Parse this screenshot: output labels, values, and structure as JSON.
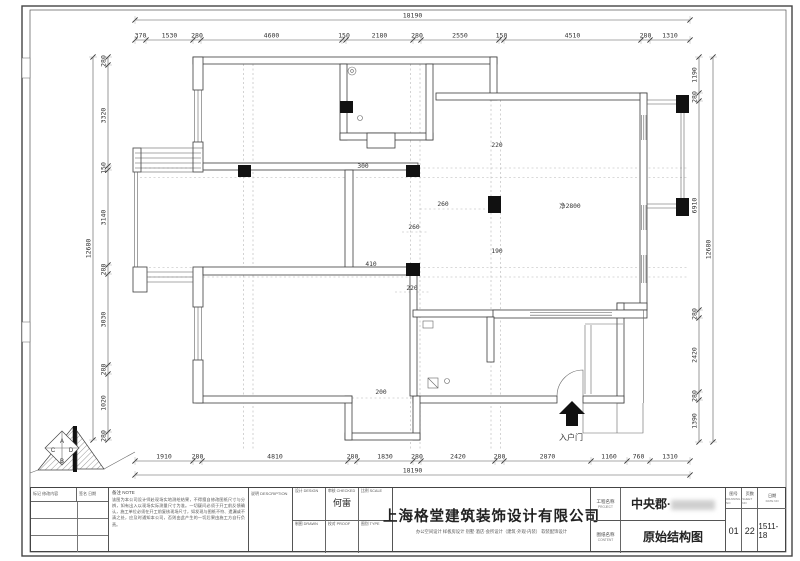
{
  "drawing": {
    "dimensions": {
      "top": {
        "total": "18190",
        "segments": [
          "370",
          "1530",
          "280",
          "4600",
          "150",
          "2180",
          "280",
          "2550",
          "150",
          "4510",
          "280",
          "1310"
        ]
      },
      "bottom": {
        "total": "18190",
        "segments": [
          "1910",
          "280",
          "4810",
          "280",
          "1830",
          "280",
          "2420",
          "280",
          "2870",
          "1160",
          "760",
          "1310"
        ]
      },
      "left": {
        "total": "12680",
        "segments": [
          "280",
          "3320",
          "150",
          "3140",
          "280",
          "3030",
          "280",
          "1020",
          "280"
        ]
      },
      "right": {
        "total": "12680",
        "segments": [
          "1190",
          "280",
          "6910",
          "280",
          "2420",
          "280",
          "1390"
        ]
      }
    },
    "interior_dims": [
      "300",
      "220",
      "260",
      "260",
      "410",
      "220",
      "190",
      "200"
    ],
    "labels": {
      "entry_door": "入户门",
      "ceiling_height": "净2800"
    },
    "logo_letters": [
      "A",
      "B",
      "C",
      "D"
    ]
  },
  "title_block": {
    "revision": {
      "header1": "标记  修改内容",
      "header2": "签名  日期"
    },
    "note": {
      "label": "备注  NOTE",
      "text": "该图为本公司设计师赴现场实地测绘结果，不得擅自修改图纸尺寸与分辨，如有出入以现场实际测量尺寸为准。一切疑问必须于开工前反馈确认，施工单位必须在开工前复核现场尺寸，如发现与图纸不符、遗漏或不清之处，应及时通知本公司，否则由此产生的一切后果由施工方自行负责。"
    },
    "description": {
      "label": "说明  DESCRIPTION"
    },
    "personnel": [
      {
        "label": "设计  DESIGN",
        "value": ""
      },
      {
        "label": "审核  CHECKED",
        "value": "何雷"
      },
      {
        "label": "比例  SCALE",
        "value": ""
      },
      {
        "label": "制图  DRAWN",
        "value": ""
      },
      {
        "label": "校对  PROOF",
        "value": ""
      },
      {
        "label": "图别  TYPE",
        "value": ""
      }
    ],
    "company": {
      "name": "上海格堂建筑装饰设计有限公司",
      "services": "办公空间设计  样板房设计  别墅·酒店·会所设计（建筑·外观·内装）  软装配饰设计"
    },
    "project": {
      "label": "工程名称",
      "label_en": "PROJECT",
      "value": "中央郡·"
    },
    "content": {
      "label": "图纸名称",
      "label_en": "CONTENT",
      "value": "原始结构图"
    },
    "numbers": [
      {
        "label": "图号",
        "label_en": "DRAWING NO",
        "value": "01"
      },
      {
        "label": "页数",
        "label_en": "SHEET NO",
        "value": "22"
      },
      {
        "label": "日期",
        "label_en": "DATE NO",
        "value": "1511-18"
      }
    ]
  }
}
